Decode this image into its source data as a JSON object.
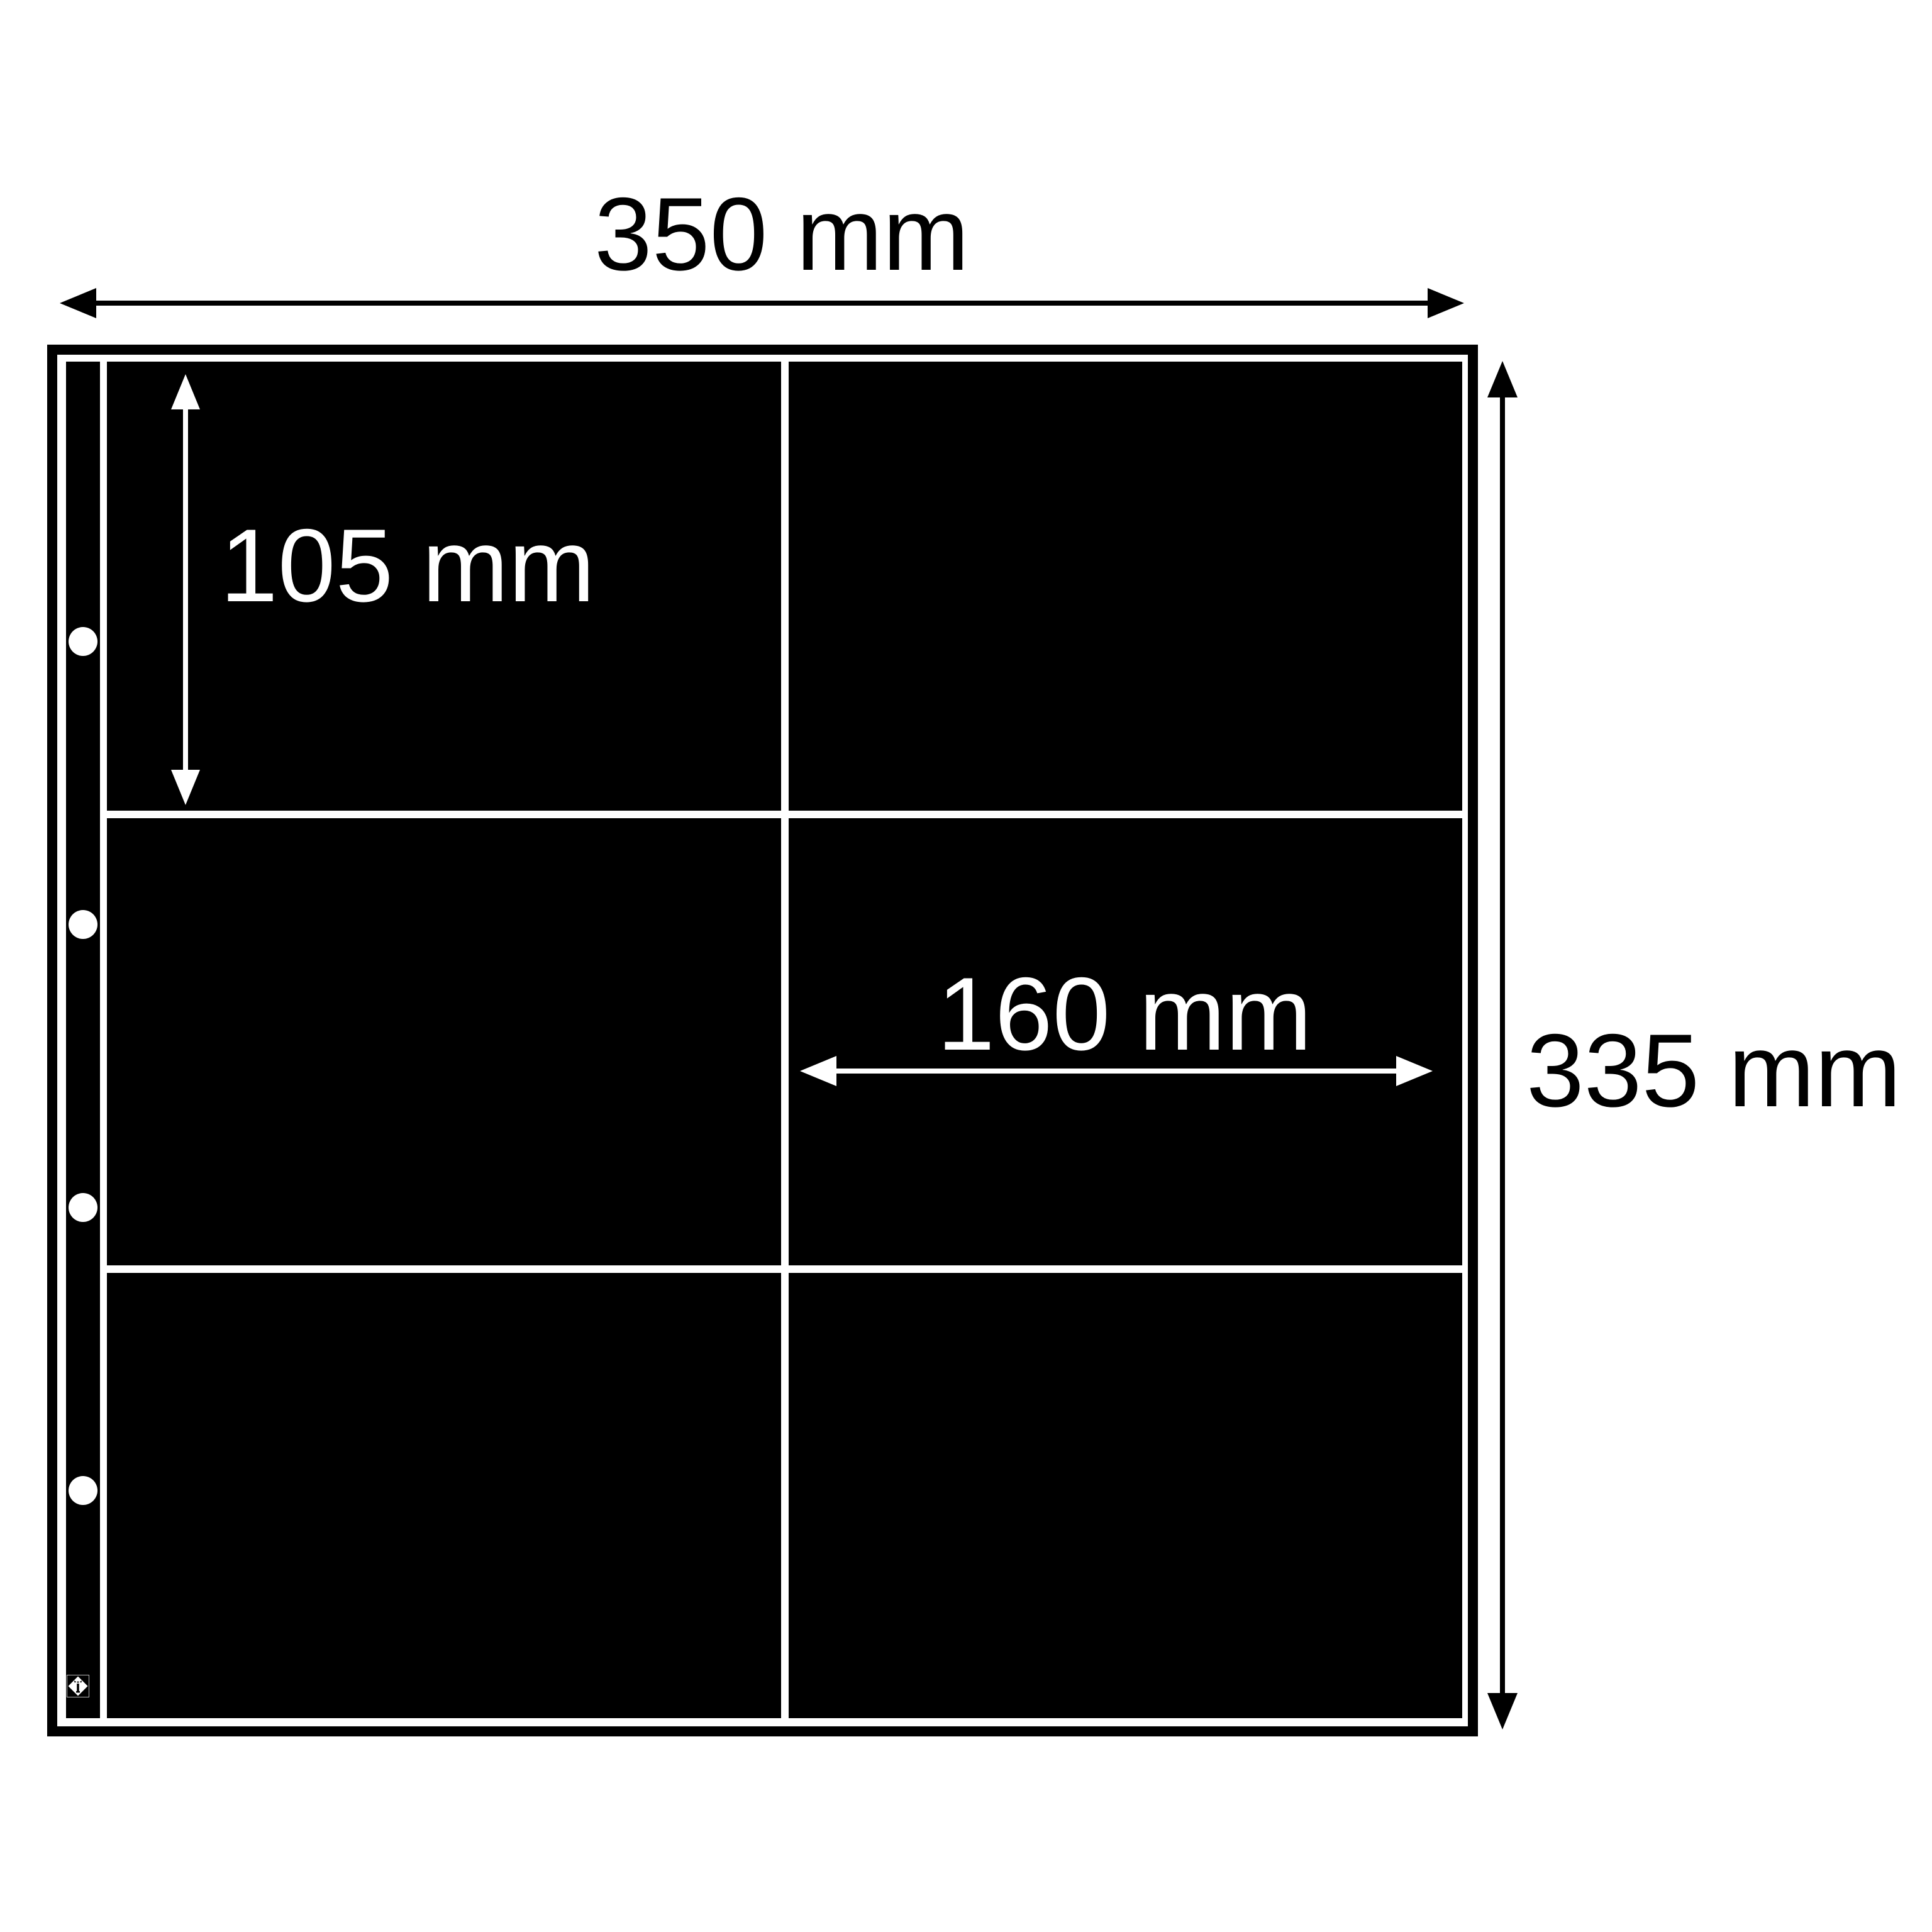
{
  "diagram": {
    "background_color": "#ffffff",
    "sheet_color": "#000000",
    "accent_white": "#ffffff",
    "labels": {
      "sheet_width": "350 mm",
      "sheet_height": "335 mm",
      "pocket_height": "105 mm",
      "pocket_width": "160 mm"
    },
    "grid": {
      "rows": 3,
      "columns": 2,
      "pocket_count": 6
    },
    "binder_hole_count": 4,
    "brand_logo": "lighthouse-diamond-logo"
  }
}
